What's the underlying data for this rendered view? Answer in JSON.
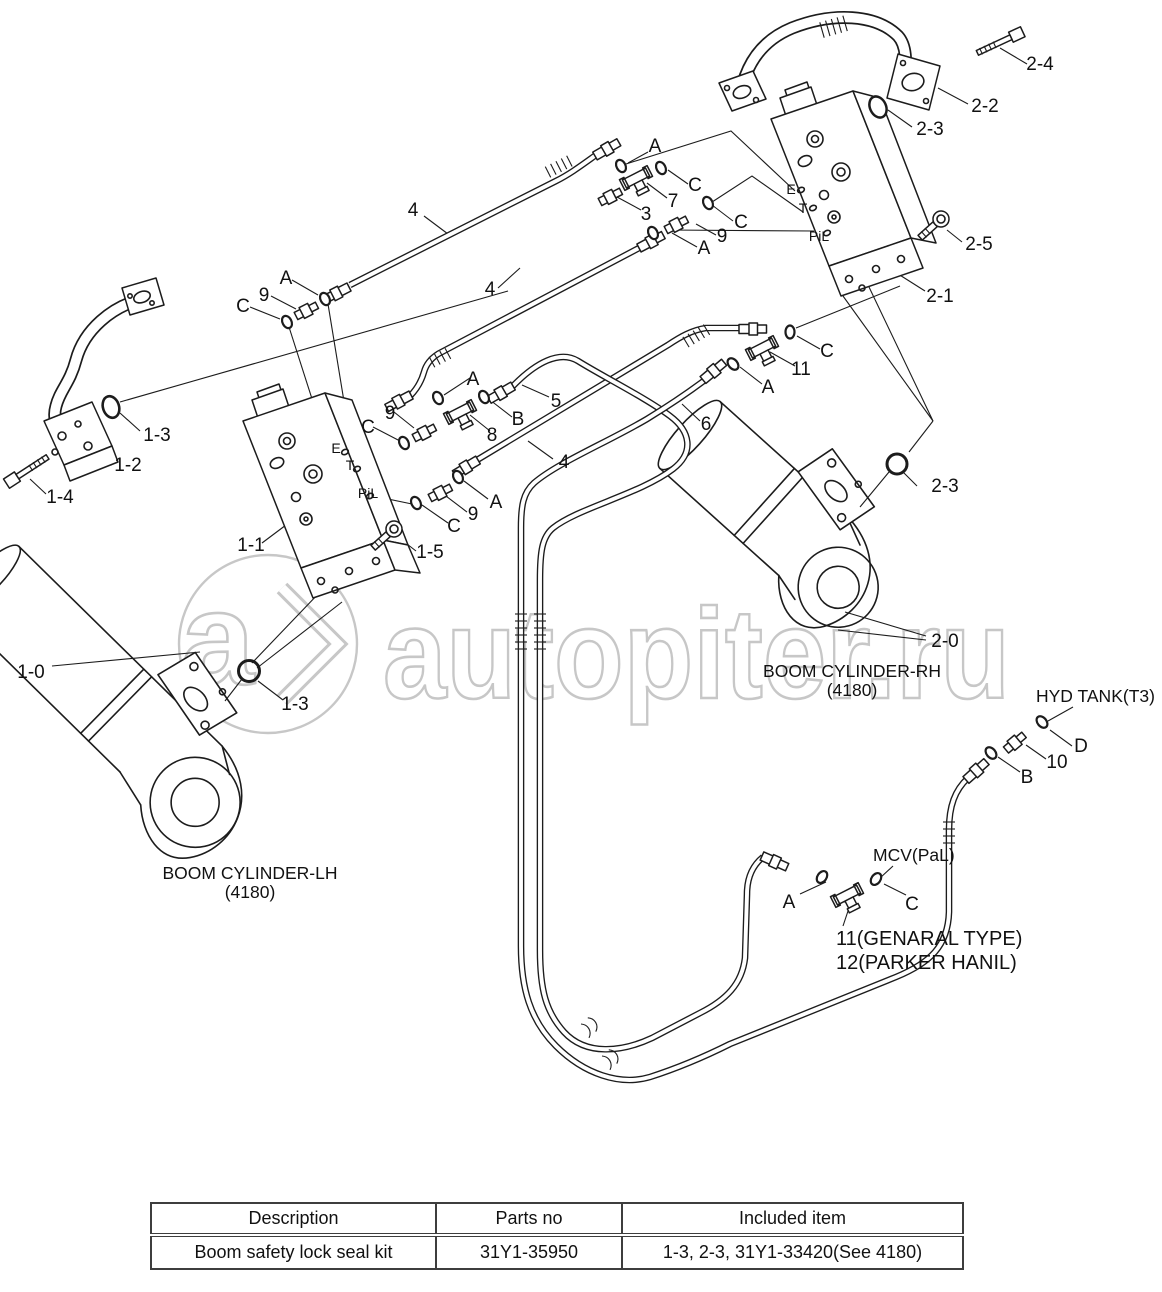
{
  "watermark": {
    "text": "autopiter.ru",
    "logo_letter": "a",
    "color": "#c7c7c7"
  },
  "diagram": {
    "callouts": {
      "k24": "2-4",
      "k22": "2-2",
      "k23a": "2-3",
      "k25": "2-5",
      "k21": "2-1",
      "k4a": "4",
      "kA1": "A",
      "k7": "7",
      "kC1": "C",
      "k3": "3",
      "kC2": "C",
      "k9a": "9",
      "kA2": "A",
      "k4b": "4",
      "kA3": "A",
      "k9b": "9",
      "kC3": "C",
      "k13a": "1-3",
      "k12": "1-2",
      "k14": "1-4",
      "k11v": "1-1",
      "k15": "1-5",
      "k9c": "9",
      "kC4": "C",
      "k8": "8",
      "kB1": "B",
      "kA4": "A",
      "k5": "5",
      "k4c": "4",
      "kA5": "A",
      "k9d": "9",
      "kC5": "C",
      "k6": "6",
      "kA6": "A",
      "k11": "11",
      "kC6": "C",
      "k23b": "2-3",
      "k20": "2-0",
      "k10v": "1-0",
      "k13b": "1-3",
      "kD": "D",
      "k10": "10",
      "kB2": "B",
      "kA7": "A",
      "kC7": "C"
    },
    "ports": {
      "e1": "E",
      "t1": "T",
      "pil1": "PiL",
      "e2": "E",
      "t2": "T",
      "pil2": "PiL"
    },
    "captions": {
      "lh_title": "BOOM CYLINDER-LH",
      "lh_sub": "(4180)",
      "rh_title": "BOOM CYLINDER-RH",
      "rh_sub": "(4180)",
      "hyd_tank": "HYD TANK(T3)",
      "mcv": "MCV(PaL)",
      "note_general": "11(GENARAL TYPE)",
      "note_parker": "12(PARKER HANIL)"
    }
  },
  "table": {
    "headers": [
      "Description",
      "Parts no",
      "Included item"
    ],
    "rows": [
      [
        "Boom safety lock seal kit",
        "31Y1-35950",
        "1-3, 2-3, 31Y1-33420(See 4180)"
      ]
    ]
  }
}
